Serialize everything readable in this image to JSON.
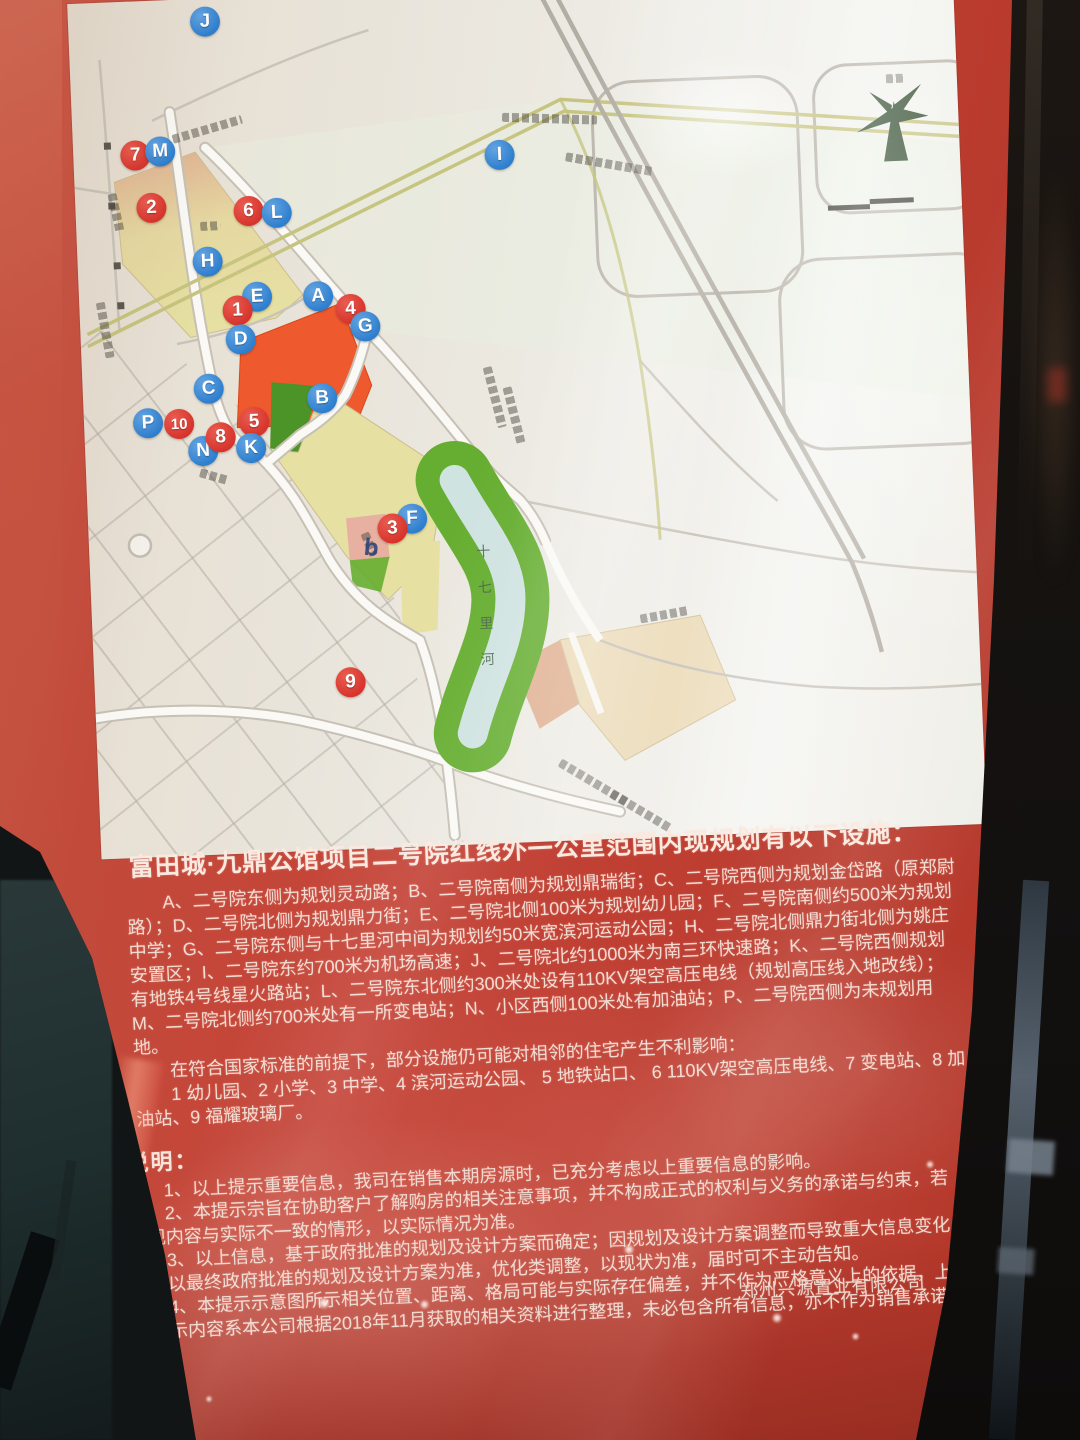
{
  "colors": {
    "poster_red": "#c2443a",
    "marker_red": "#d6332b",
    "marker_blue": "#2d7ece",
    "map_paper": "#e6e2da",
    "parcel_yellow": "#e6e0a2",
    "parcel_orange": "#ee5a2e",
    "parcel_salmon": "#e0b193",
    "parcel_pink": "#e8b0a0",
    "parcel_tan": "#ecdcba",
    "park_green": "#66ae31",
    "park_green_dark": "#4d9428",
    "river_blue": "#cfe3e1",
    "road_olive": "#c6c47e"
  },
  "map": {
    "river_label": "十七里河",
    "small_label": "b",
    "icons": {
      "compass": "tree-compass-icon",
      "scale_bar": "map-scale-bar"
    },
    "markers": [
      {
        "id": "J",
        "x": 137,
        "y": 23
      },
      {
        "id": "7",
        "x": 62,
        "y": 154
      },
      {
        "id": "M",
        "x": 87,
        "y": 151
      },
      {
        "id": "2",
        "x": 76,
        "y": 207
      },
      {
        "id": "6",
        "x": 173,
        "y": 214
      },
      {
        "id": "L",
        "x": 201,
        "y": 217
      },
      {
        "id": "I",
        "x": 426,
        "y": 168
      },
      {
        "id": "H",
        "x": 130,
        "y": 263
      },
      {
        "id": "E",
        "x": 178,
        "y": 300
      },
      {
        "id": "1",
        "x": 158,
        "y": 313
      },
      {
        "id": "A",
        "x": 239,
        "y": 302
      },
      {
        "id": "4",
        "x": 271,
        "y": 316
      },
      {
        "id": "G",
        "x": 285,
        "y": 334
      },
      {
        "id": "D",
        "x": 160,
        "y": 342
      },
      {
        "id": "C",
        "x": 126,
        "y": 390
      },
      {
        "id": "B",
        "x": 239,
        "y": 404
      },
      {
        "id": "P",
        "x": 64,
        "y": 422
      },
      {
        "id": "10",
        "x": 95,
        "y": 424
      },
      {
        "id": "N",
        "x": 118,
        "y": 452
      },
      {
        "id": "8",
        "x": 136,
        "y": 439
      },
      {
        "id": "5",
        "x": 170,
        "y": 425
      },
      {
        "id": "K",
        "x": 166,
        "y": 451
      },
      {
        "id": "F",
        "x": 324,
        "y": 528
      },
      {
        "id": "3",
        "x": 304,
        "y": 537
      },
      {
        "id": "9",
        "x": 256,
        "y": 689
      }
    ]
  },
  "poster": {
    "title": "富田城·九鼎公馆项目二号院红线外一公里范围内现规划有以下设施：",
    "facility_paragraphs": [
      "A、二号院东侧为规划灵动路；B、二号院南侧为规划鼎瑞街；C、二号院西侧为规划金岱路（原郑尉路）；D、二号院北侧为规划鼎力街；E、二号院北侧100米为规划幼儿园；F、二号院南侧约500米为规划中学；G、二号院东侧与十七里河中间为规划约50米宽滨河运动公园；H、二号院北侧鼎力街北侧为姚庄安置区；I、二号院东约700米为机场高速；J、二号院北约1000米为南三环快速路；K、二号院西侧规划有地铁4号线星火路站；L、二号院东北侧约300米处设有110KV架空高压电线（规划高压线入地改线）；M、二号院北侧约700米处有一所变电站；N、小区西侧100米处有加油站；P、二号院西侧为未规划用地。",
      "在符合国家标准的前提下，部分设施仍可能对相邻的住宅产生不利影响：",
      "1 幼儿园、2 小学、3 中学、4 滨河运动公园、 5 地铁站口、 6 110KV架空高压电线、7 变电站、8 加油站、9 福耀玻璃厂。"
    ],
    "notes_heading": "说明：",
    "notes": [
      "1、以上提示重要信息，我司在销售本期房源时，已充分考虑以上重要信息的影响。",
      "2、本提示宗旨在协助客户了解购房的相关注意事项，并不构成正式的权利与义务的承诺与约束，若出现内容与实际不一致的情形，以实际情况为准。",
      "3、以上信息，基于政府批准的规划及设计方案而确定；因规划及设计方案调整而导致重大信息变化的，以最终政府批准的规划及设计方案为准，优化类调整，以现状为准，届时可不主动告知。",
      "4、本提示示意图所示相关位置、距离、格局可能与实际存在偏差，并不作为严格意义上的依据，上述提示内容系本公司根据2018年11月获取的相关资料进行整理，未必包含所有信息，亦不作为销售承诺。"
    ],
    "company": "郑州兴源置业有限公司"
  }
}
